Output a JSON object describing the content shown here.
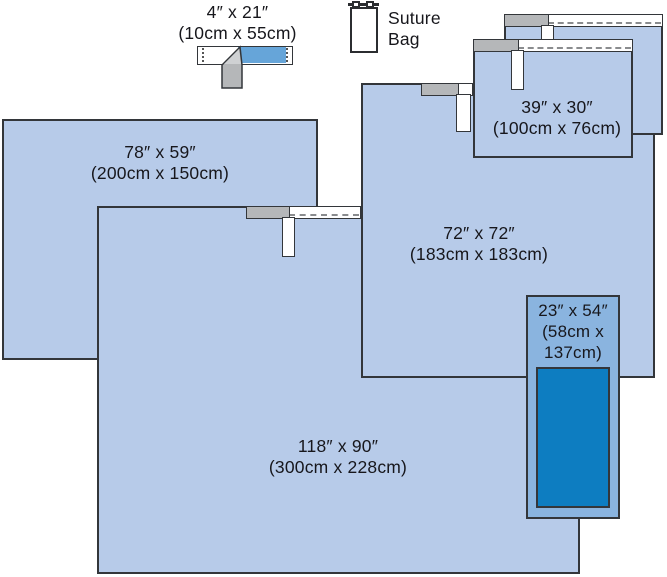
{
  "colors": {
    "background": "#ffffff",
    "drape_blue": "#b7cbe9",
    "drape_border": "#33363a",
    "accent_drape_blue": "#8ab4df",
    "incise_film_blue": "#0d7dc1",
    "tape_blue": "#66a5d9",
    "gray_fold": "#b5b7b9",
    "gray_fold_light": "#cfd1d3",
    "dash_gray": "#8a8c8e",
    "text_color": "#17171c"
  },
  "items": {
    "tape_4x21": {
      "size_in": "4″ x 21″",
      "size_cm": "(10cm x 55cm)"
    },
    "suture_bag": {
      "line1": "Suture",
      "line2": "Bag"
    },
    "drape_39x30": {
      "size_in": "39″ x 30″",
      "size_cm": "(100cm x 76cm)"
    },
    "drape_78x59": {
      "size_in": "78″ x 59″",
      "size_cm": "(200cm x 150cm)"
    },
    "drape_72x72": {
      "size_in": "72″ x 72″",
      "size_cm": "(183cm x 183cm)"
    },
    "drape_118x90": {
      "size_in": "118″ x 90″",
      "size_cm": "(300cm x 228cm)"
    },
    "drape_23x54": {
      "size_in": "23″ x 54″",
      "size_cm_line1": "(58cm x",
      "size_cm_line2": "137cm)"
    }
  }
}
